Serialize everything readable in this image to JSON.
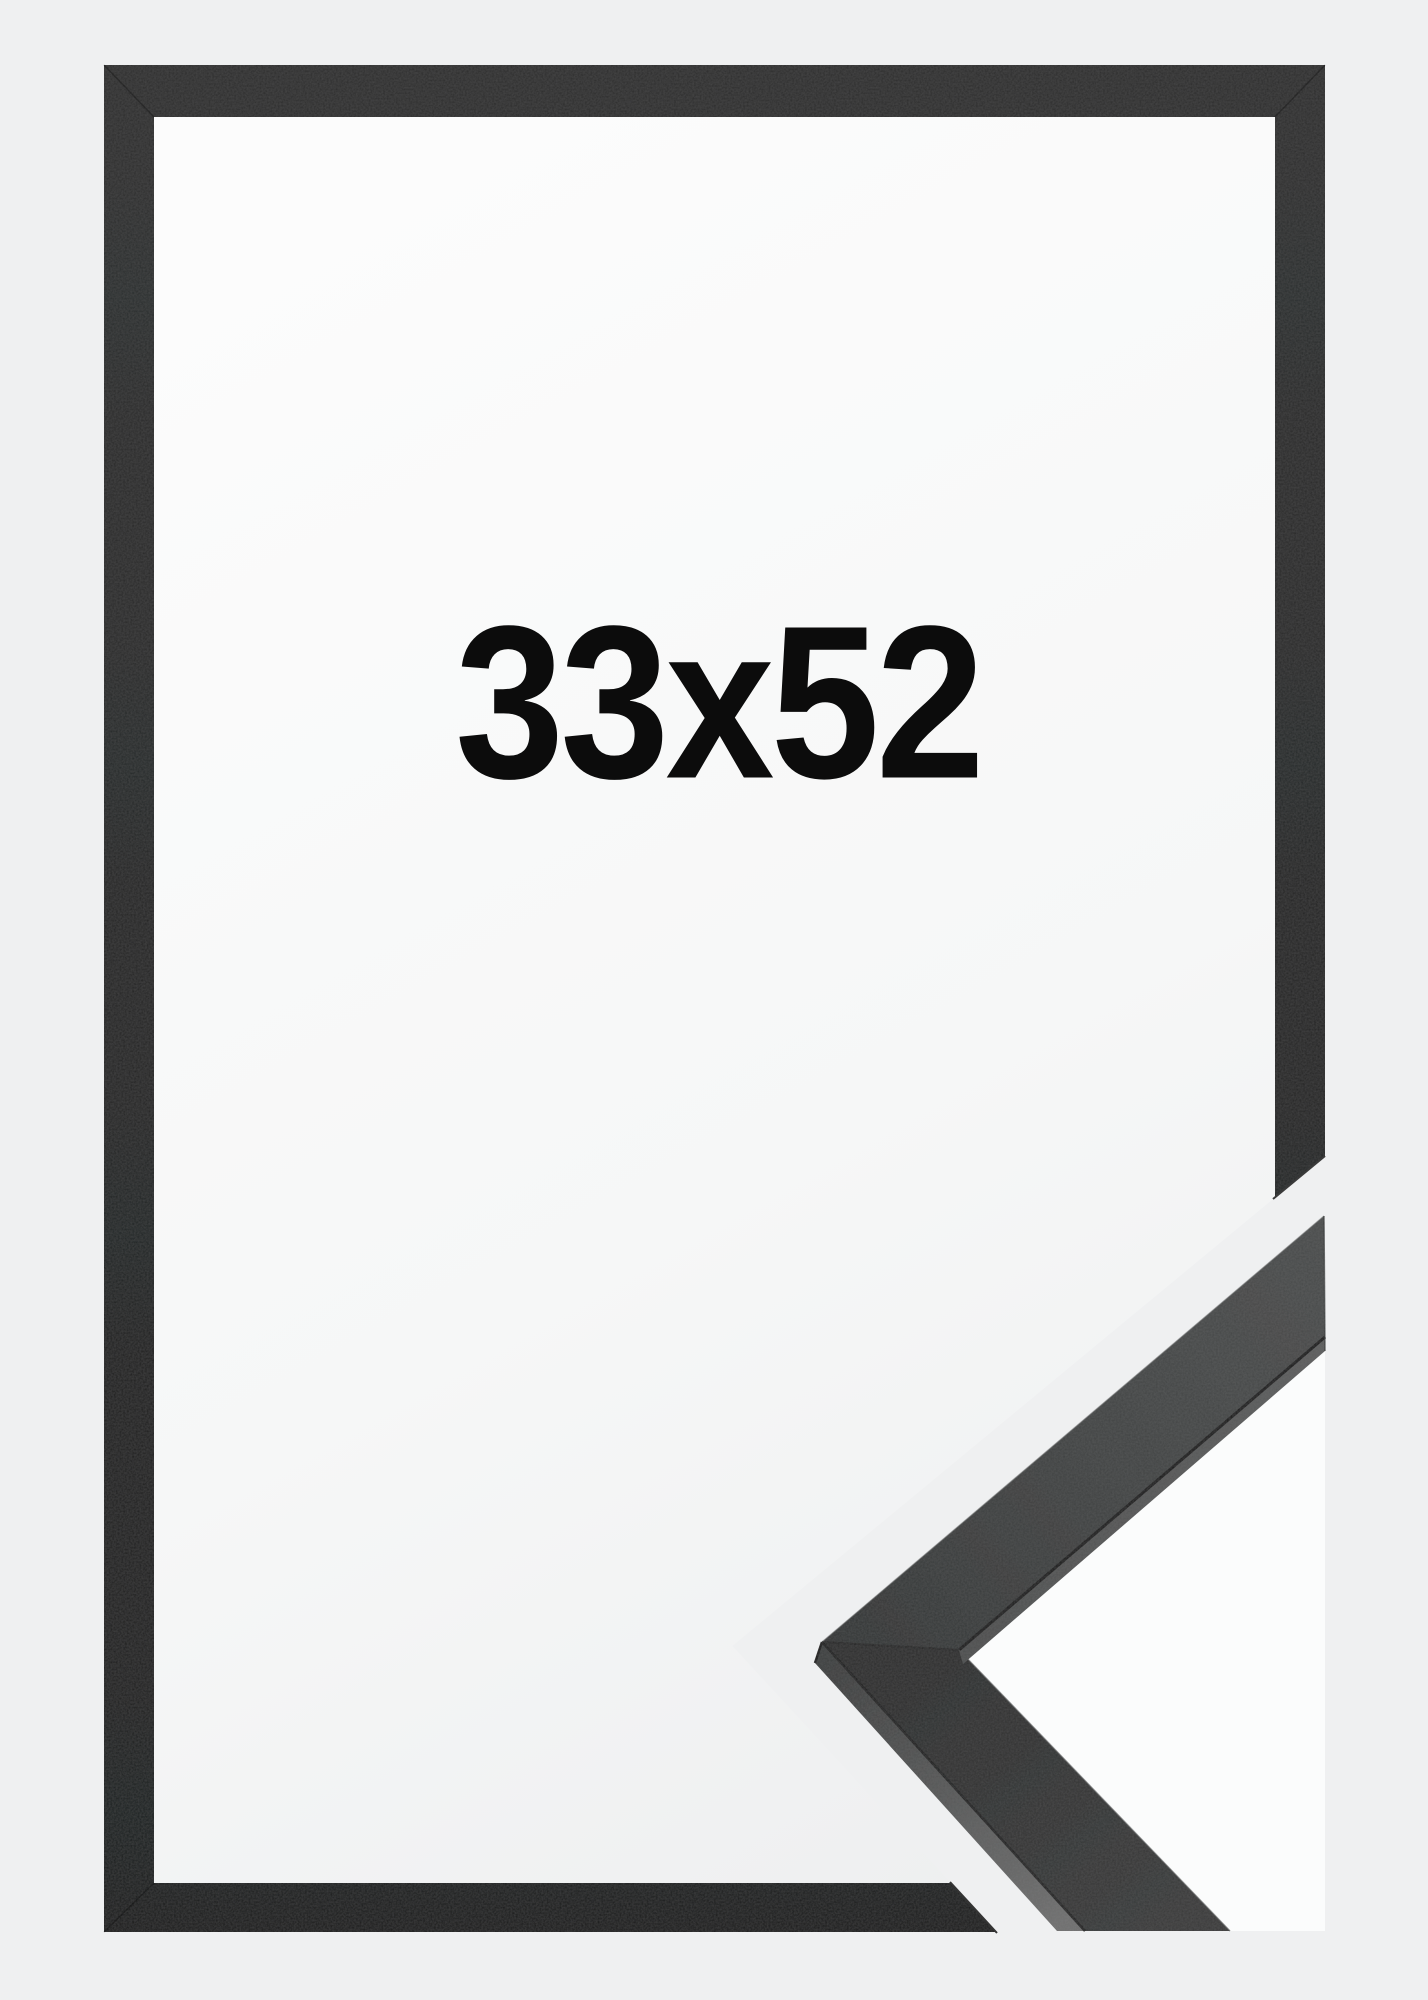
{
  "product_image": {
    "size_label": "33x52"
  },
  "colors": {
    "background": "#eff0f1",
    "interior_white": "#fcfcfc",
    "frame_top": "#2e2f2f",
    "frame_bottom": "#1e1f1f",
    "label_text": "#0c0c0c",
    "detail_face_light": "#4b4d4d",
    "detail_face_dark": "#2d2e2e",
    "detail_side_band_light": "#707070",
    "detail_side_band_mid": "#5c5d5d",
    "detail_edge_dark": "#1d1d1d",
    "wedge_white": "#fbfcfc"
  }
}
